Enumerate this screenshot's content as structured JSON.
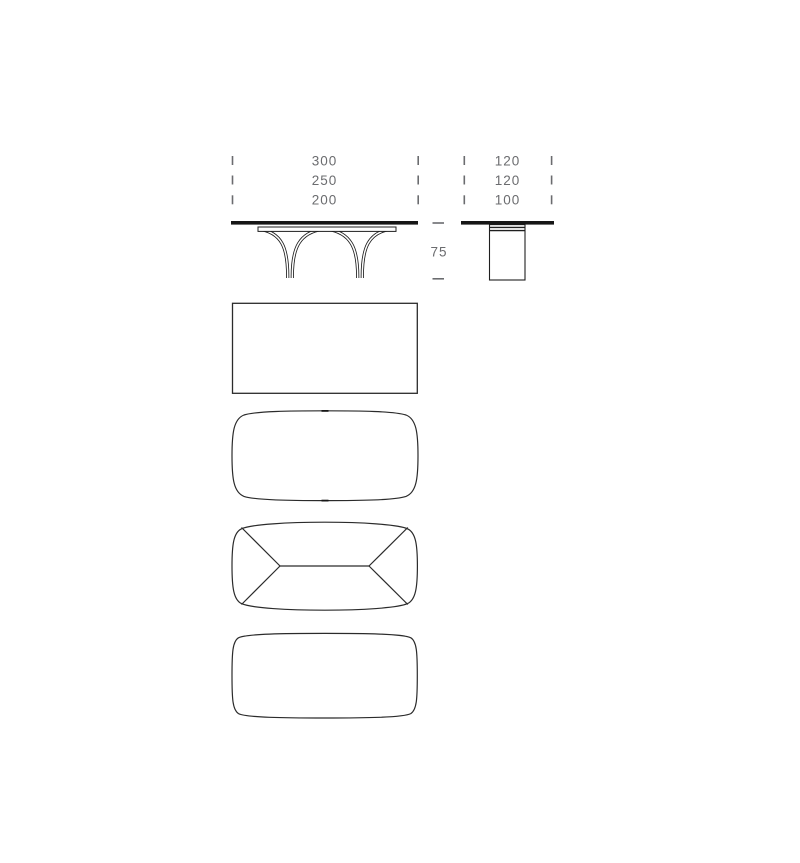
{
  "drawing": {
    "front_view": {
      "width_labels": [
        "300",
        "250",
        "200"
      ]
    },
    "side_view": {
      "depth_labels": [
        "120",
        "120",
        "100"
      ]
    },
    "height_label": "75"
  },
  "colors": {
    "background": "#ffffff",
    "line": "#1f1f1f",
    "outline": "#2b2b2b",
    "dimension": "#6b6c6f"
  }
}
